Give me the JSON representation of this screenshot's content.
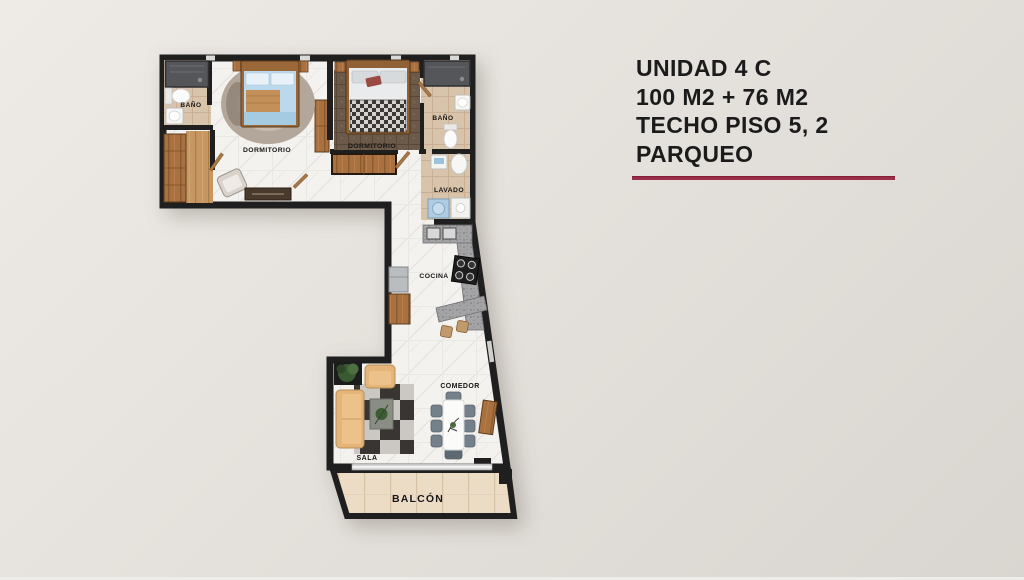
{
  "title_block": {
    "lines": [
      "UNIDAD 4 C",
      "100 M2 + 76 M2",
      "TECHO PISO 5, 2",
      "PARQUEO"
    ],
    "divider_color": "#9c2e4a"
  },
  "floorplan": {
    "rooms": {
      "bath1": "BAÑO",
      "bed1": "DORMITORIO",
      "bed2": "DORMITORIO",
      "bath2": "BAÑO",
      "laundry": "LAVADO",
      "kitchen": "COCINA",
      "dining": "COMEDOR",
      "living": "SALA",
      "balcony": "BALCÓN"
    },
    "colors": {
      "wall": "#1f1f1f",
      "marble_floor": "#f4f2ef",
      "bath_floor": "#d8c3ab",
      "wood": "#a9713f",
      "balcony_floor": "#ecdcc6",
      "counter_granite": "#a4a4a6",
      "sofa_tan": "#e4b478",
      "bed_blue": "#bcd8ec"
    }
  }
}
